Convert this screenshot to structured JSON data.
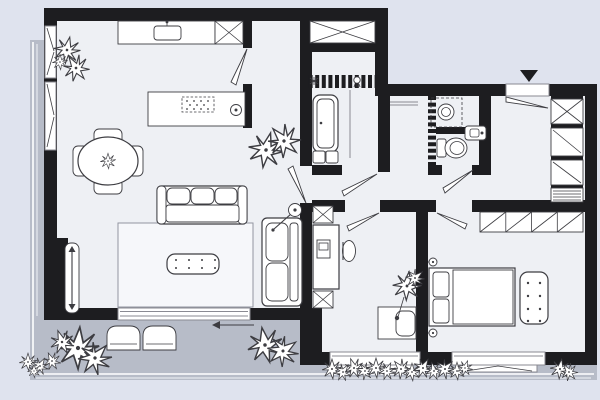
{
  "plan": {
    "title": "apartment floor plan with terrace",
    "colors": {
      "background": "#dfe3ee",
      "terrace": "#b7bcc8",
      "floor": "#eef0f4",
      "wall": "#1d1d20",
      "line": "#3d3d42",
      "rug": "#f6f7fa",
      "furniture": "#ffffff",
      "tile": "#2f2f34",
      "frame": "#8a8a92"
    },
    "markers": {
      "entrance": "filled-triangle-down",
      "terrace_door": "slide-arrow-left"
    },
    "rooms": [
      {
        "id": "living-room-kitchen",
        "furniture": [
          {
            "item": "kitchen-counter",
            "count": 1
          },
          {
            "item": "kitchen-sink",
            "count": 1
          },
          {
            "item": "tall-cabinet-x",
            "count": 1
          },
          {
            "item": "kitchen-island",
            "count": 1
          },
          {
            "item": "cooktop-dotted",
            "count": 1
          },
          {
            "item": "island-sink-round",
            "count": 1
          },
          {
            "item": "dining-table-round",
            "count": 1
          },
          {
            "item": "dining-chair",
            "count": 4
          },
          {
            "item": "sofa-three-seat",
            "count": 1
          },
          {
            "item": "rug",
            "count": 1
          },
          {
            "item": "coffee-table-dotted",
            "count": 1
          },
          {
            "item": "chaise-longue",
            "count": 1
          },
          {
            "item": "floor-lamp",
            "count": 1
          },
          {
            "item": "radiator",
            "count": 1
          },
          {
            "item": "potted-plant",
            "count": 3
          }
        ]
      },
      {
        "id": "bathroom",
        "furniture": [
          {
            "item": "bathtub",
            "count": 1
          },
          {
            "item": "vanity-basin",
            "count": 2
          },
          {
            "item": "tiled-wall-band",
            "count": 1
          },
          {
            "item": "ceiling-light-symbol",
            "count": 1
          },
          {
            "item": "shower-mixer-symbol",
            "count": 1
          },
          {
            "item": "shower-screen",
            "count": 1
          }
        ]
      },
      {
        "id": "laundry-wc",
        "furniture": [
          {
            "item": "washing-machine",
            "count": 1
          },
          {
            "item": "toilet",
            "count": 1
          },
          {
            "item": "hand-basin",
            "count": 1
          },
          {
            "item": "towel-rail",
            "count": 1
          }
        ]
      },
      {
        "id": "entry-hall",
        "furniture": [
          {
            "item": "entrance-door",
            "count": 1
          },
          {
            "item": "ventilation-shaft-x",
            "count": 1
          },
          {
            "item": "closet",
            "count": 2
          },
          {
            "item": "radiator-hatched",
            "count": 1
          }
        ]
      },
      {
        "id": "bedroom-office",
        "furniture": [
          {
            "item": "desk",
            "count": 1
          },
          {
            "item": "desk-cabinet-x",
            "count": 2
          },
          {
            "item": "monitor",
            "count": 1
          },
          {
            "item": "desk-chair",
            "count": 1
          },
          {
            "item": "side-table",
            "count": 1
          },
          {
            "item": "side-chair",
            "count": 1
          },
          {
            "item": "potted-plant",
            "count": 1
          }
        ]
      },
      {
        "id": "bedroom",
        "furniture": [
          {
            "item": "wardrobe-four-section",
            "count": 1
          },
          {
            "item": "double-bed",
            "count": 1
          },
          {
            "item": "pillow",
            "count": 2
          },
          {
            "item": "wall-lamp",
            "count": 2
          },
          {
            "item": "bench-dotted",
            "count": 1
          }
        ]
      },
      {
        "id": "terrace",
        "furniture": [
          {
            "item": "terrace-chair",
            "count": 2
          },
          {
            "item": "potted-plant",
            "count": 2
          },
          {
            "item": "flower-cluster",
            "count": 1
          }
        ]
      },
      {
        "id": "garden-strip",
        "furniture": [
          {
            "item": "shrub-row",
            "count": 2
          },
          {
            "item": "shrub-single",
            "count": 1
          }
        ]
      }
    ],
    "shaft_count": 2,
    "door_count": 8,
    "window_count": 5
  }
}
